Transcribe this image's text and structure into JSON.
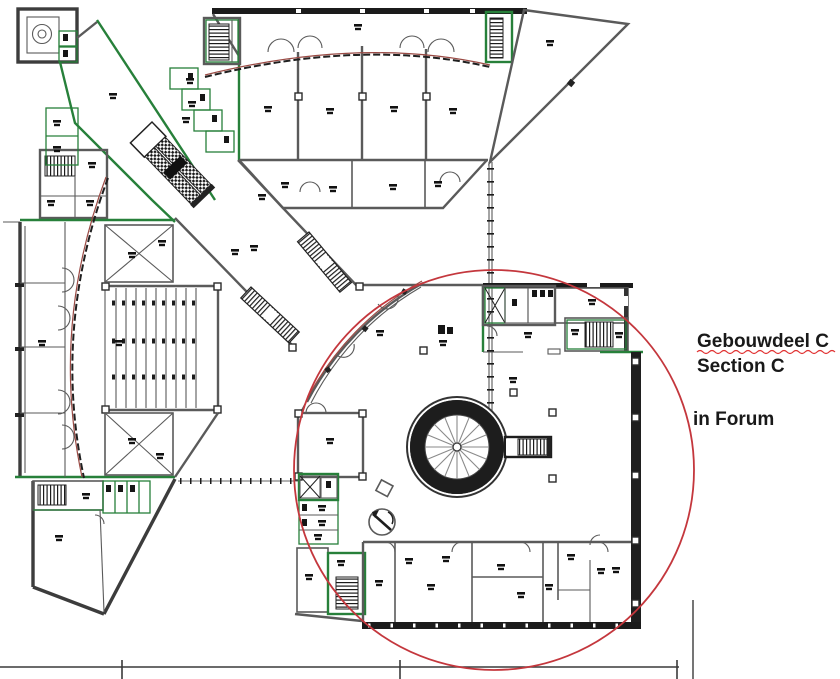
{
  "annotation": {
    "title": "Gebouwdeel C",
    "subtitle": "Section C",
    "note": "in Forum"
  },
  "drawing": {
    "kind": "architectural floor plan",
    "highlighted_section": "Section C",
    "highlight_shape": "red circle",
    "features": [
      "spiral-staircase",
      "auditorium-seating",
      "escalators",
      "stair-cores",
      "elevator-cores"
    ]
  },
  "colors": {
    "highlight_red": "#c4373d",
    "facade_red": "#9a4a44",
    "wall_green": "#27803a",
    "wall_gray": "#5a5a5a",
    "wall_dark": "#1f1f1f",
    "background": "#ffffff"
  }
}
